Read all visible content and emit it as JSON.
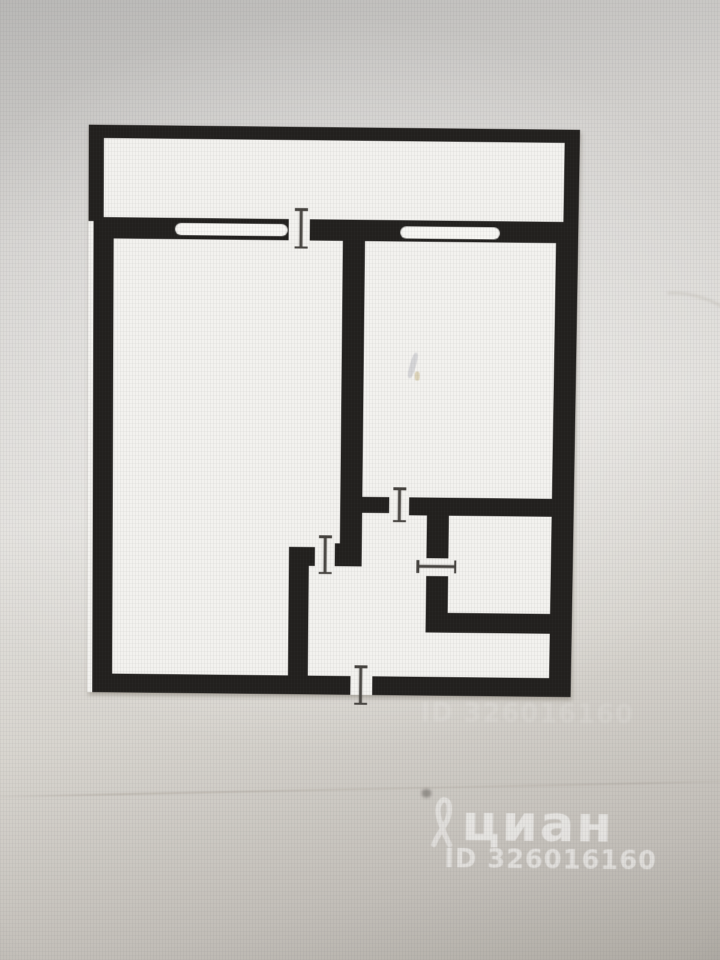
{
  "watermark": {
    "brand": "циан",
    "id_text": "ID 326016160",
    "icon": "cian-ribbon-icon",
    "color": "#ffffff"
  },
  "watermark_secondary": {
    "id_text": "ID 326016160"
  },
  "floorplan": {
    "wall_color": "#22201e",
    "floor_color": "#f3f2ef",
    "window_color": "#f7f6f3",
    "tick_color": "#45423e",
    "floor": {
      "name": "floor-area",
      "x": 88,
      "y": 130,
      "w": 487,
      "h": 567
    },
    "walls": [
      {
        "name": "balcony-top-wall",
        "x": 88,
        "y": 130,
        "w": 487,
        "h": 13
      },
      {
        "name": "balcony-left-wall",
        "x": 88,
        "y": 130,
        "w": 15,
        "h": 95
      },
      {
        "name": "balcony-right-wall",
        "x": 560,
        "y": 134,
        "w": 15,
        "h": 92
      },
      {
        "name": "main-top-wall-left",
        "x": 93,
        "y": 221,
        "w": 194,
        "h": 21
      },
      {
        "name": "main-top-wall-right",
        "x": 308,
        "y": 221,
        "w": 267,
        "h": 21
      },
      {
        "name": "left-outer-wall",
        "x": 93,
        "y": 221,
        "w": 20,
        "h": 476
      },
      {
        "name": "right-outer-wall",
        "x": 553,
        "y": 221,
        "w": 22,
        "h": 476
      },
      {
        "name": "bottom-outer-wall-left",
        "x": 93,
        "y": 678,
        "w": 260,
        "h": 19
      },
      {
        "name": "bottom-outer-wall-right",
        "x": 375,
        "y": 678,
        "w": 200,
        "h": 19
      },
      {
        "name": "room-divider-wall",
        "x": 341,
        "y": 242,
        "w": 22,
        "h": 325
      },
      {
        "name": "room-divider-foot",
        "x": 336,
        "y": 544,
        "w": 27,
        "h": 23
      },
      {
        "name": "kitchen-door-stub",
        "x": 363,
        "y": 497,
        "w": 27,
        "h": 16
      },
      {
        "name": "bathroom-top-wall",
        "x": 410,
        "y": 497,
        "w": 143,
        "h": 18
      },
      {
        "name": "bathroom-left-wall-upper",
        "x": 428,
        "y": 515,
        "w": 22,
        "h": 43
      },
      {
        "name": "bathroom-left-wall-lower",
        "x": 428,
        "y": 576,
        "w": 22,
        "h": 57
      },
      {
        "name": "bathroom-bottom-wall",
        "x": 428,
        "y": 613,
        "w": 125,
        "h": 20
      },
      {
        "name": "hallway-left-wall",
        "x": 290,
        "y": 548,
        "w": 20,
        "h": 149
      },
      {
        "name": "hallway-top-wall",
        "x": 290,
        "y": 548,
        "w": 26,
        "h": 19
      }
    ],
    "windows": [
      {
        "name": "window-left-room",
        "x": 174,
        "y": 226,
        "w": 112,
        "h": 12
      },
      {
        "name": "window-kitchen",
        "x": 398,
        "y": 227,
        "w": 99,
        "h": 12
      }
    ],
    "door_ticks": [
      {
        "name": "balcony-door-tick",
        "orientation": "v",
        "cx": 299,
        "y1": 211,
        "y2": 249
      },
      {
        "name": "living-room-door-tick",
        "orientation": "v",
        "cx": 326,
        "y1": 537,
        "y2": 574
      },
      {
        "name": "kitchen-door-tick",
        "orientation": "v",
        "cx": 400,
        "y1": 488,
        "y2": 521
      },
      {
        "name": "bathroom-door-tick",
        "orientation": "h",
        "cy": 566,
        "x1": 419,
        "x2": 457
      },
      {
        "name": "entrance-door-tick",
        "orientation": "v",
        "cx": 363,
        "y1": 668,
        "y2": 706
      }
    ],
    "artifacts": [
      {
        "name": "scratch-streak",
        "x": 409,
        "y": 352,
        "w": 6,
        "h": 26,
        "rot": 15,
        "color": "rgba(110,110,130,0.22)"
      },
      {
        "name": "scratch-speck",
        "x": 414,
        "y": 371,
        "w": 5,
        "h": 9,
        "rot": 0,
        "color": "rgba(170,140,60,0.30)"
      }
    ]
  }
}
